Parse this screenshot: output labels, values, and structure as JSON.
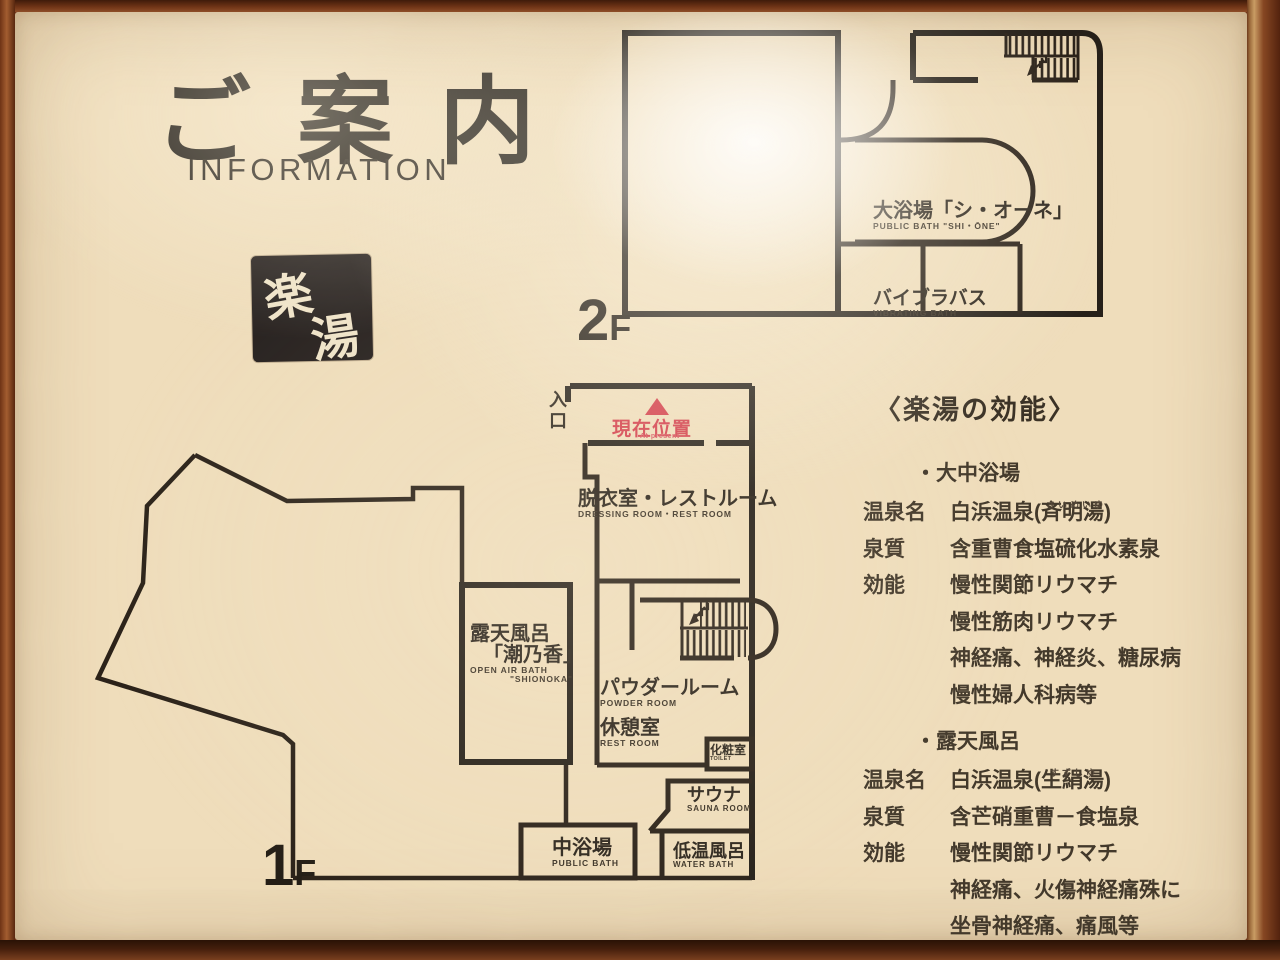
{
  "sign": {
    "title_jp": "ご案内",
    "title_en": "INFORMATION"
  },
  "stamp": {
    "char_top": "楽",
    "char_bottom": "湯"
  },
  "floor2": {
    "floor_number": "2",
    "floor_suffix": "F",
    "main_bath_jp": "大浴場「シ・オーネ」",
    "main_bath_en": "PUBLIC BATH \"SHI・ŌNE\"",
    "vibra_jp": "バイブラバス",
    "vibra_en": "VIBRATING BATH"
  },
  "floor1": {
    "floor_number": "1",
    "floor_suffix": "F",
    "entrance_jp": "入口",
    "current_jp": "現在位置",
    "current_en": "At present",
    "dressing_jp": "脱衣室・レストルーム",
    "dressing_en": "DRESSING ROOM・REST ROOM",
    "openair_jp1": "露天風呂",
    "openair_jp2": "「潮乃香」",
    "openair_en1": "OPEN AIR BATH",
    "openair_en2": "\"SHIONOKA\"",
    "powder_jp": "パウダールーム",
    "powder_en": "POWDER ROOM",
    "rest_jp": "休憩室",
    "rest_en": "REST ROOM",
    "toilet_jp": "化粧室",
    "toilet_en": "TOILET",
    "sauna_jp": "サウナ",
    "sauna_en": "SAUNA ROOM",
    "publicbath_jp": "中浴場",
    "publicbath_en": "PUBLIC BATH",
    "waterbath_jp": "低温風呂",
    "waterbath_en": "WATER BATH"
  },
  "efficacy": {
    "heading": "〈楽湯の効能〉",
    "section1": {
      "bullet": "・大中浴場",
      "row1_label": "温泉名",
      "row1_value": "白浜温泉(斉明湯)",
      "row1_furigana": "さいめいゆ",
      "row2_label": "泉質",
      "row2_value": "含重曹食塩硫化水素泉",
      "row3_label": "効能",
      "row3_value": "慢性関節リウマチ",
      "row4_value": "慢性筋肉リウマチ",
      "row5_value": "神経痛、神経炎、糖尿病",
      "row6_value": "慢性婦人科病等"
    },
    "section2": {
      "bullet": "・露天風呂",
      "row1_label": "温泉名",
      "row1_value": "白浜温泉(生絹湯)",
      "row1_furigana": "すずしゆ",
      "row2_label": "泉質",
      "row2_value": "含芒硝重曹－食塩泉",
      "row3_label": "効能",
      "row3_value": "慢性関節リウマチ",
      "row4_value": "神経痛、火傷神経痛殊に",
      "row5_value": "坐骨神経痛、痛風等"
    }
  },
  "colors": {
    "ink": "#2b2219",
    "accent_red": "#d23c49",
    "board": "#efddbb",
    "frame": "#6f3318"
  }
}
